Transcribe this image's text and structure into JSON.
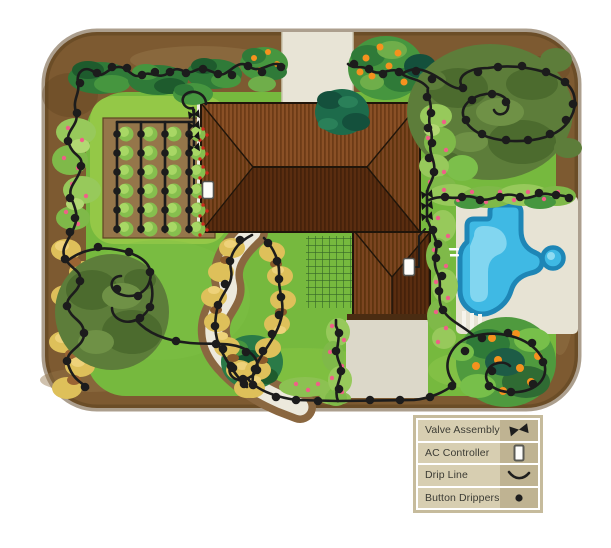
{
  "legend": {
    "items": [
      {
        "label": "Valve Assembly",
        "symbol": "valve-assembly-icon"
      },
      {
        "label": "AC Controller",
        "symbol": "ac-controller-icon"
      },
      {
        "label": "Drip Line",
        "symbol": "drip-line-icon"
      },
      {
        "label": "Button Drippers",
        "symbol": "button-dripper-icon"
      }
    ]
  },
  "colors": {
    "background": "#ffffff",
    "soil": "#7d5a31",
    "soil_dark": "#5e421f",
    "lawn": "#76b93e",
    "lawn_light": "#94c847",
    "hardscape": "#e8e4d6",
    "patio": "#dcd8c9",
    "roof_light": "#8a5026",
    "roof_dark": "#5a2d10",
    "pool_water": "#3fb9e4",
    "pool_border": "#1e86b6",
    "pool_highlight": "#8edbf2",
    "foliage_dark": "#2f7a38",
    "foliage_olive": "#5d7d3a",
    "foliage_light": "#97c95b",
    "shrub_gold": "#dec05a",
    "flower_pink": "#ef6088",
    "fruit_orange": "#f5921e",
    "drip_line": "#1c1c1c",
    "plant_green": "#86bf4e",
    "tomato_red": "#cc2b1e",
    "legend_frame": "#c6bb9c",
    "legend_label_bg": "#d7ceb1",
    "legend_symbol_bg": "#bfb392",
    "legend_text": "#3b3b34"
  },
  "plan": {
    "valve_assemblies": [
      [
        194,
        115
      ],
      [
        194,
        126
      ],
      [
        194,
        137
      ],
      [
        194,
        148
      ],
      [
        427,
        195
      ],
      [
        427,
        206
      ],
      [
        427,
        217
      ]
    ],
    "ac_controllers": [
      [
        208,
        190
      ],
      [
        409,
        267
      ]
    ],
    "vegetable_garden": {
      "columns": [
        117,
        141,
        165,
        189
      ],
      "rows": [
        134,
        153,
        172,
        191,
        210,
        229
      ],
      "tomato_column_index": 3
    },
    "drippers": [
      [
        281,
        67
      ],
      [
        262,
        72
      ],
      [
        248,
        66
      ],
      [
        232,
        75
      ],
      [
        218,
        74
      ],
      [
        203,
        69
      ],
      [
        186,
        73
      ],
      [
        170,
        72
      ],
      [
        155,
        72
      ],
      [
        142,
        75
      ],
      [
        127,
        68
      ],
      [
        112,
        67
      ],
      [
        97,
        73
      ],
      [
        80,
        83
      ],
      [
        77,
        113
      ],
      [
        68,
        141
      ],
      [
        81,
        166
      ],
      [
        70,
        198
      ],
      [
        75,
        218
      ],
      [
        70,
        232
      ],
      [
        65,
        259
      ],
      [
        80,
        281
      ],
      [
        67,
        306
      ],
      [
        84,
        333
      ],
      [
        67,
        361
      ],
      [
        85,
        387
      ],
      [
        98,
        247
      ],
      [
        129,
        252
      ],
      [
        150,
        272
      ],
      [
        138,
        296
      ],
      [
        117,
        289
      ],
      [
        150,
        307
      ],
      [
        140,
        318
      ],
      [
        176,
        341
      ],
      [
        216,
        344
      ],
      [
        246,
        352
      ],
      [
        257,
        370
      ],
      [
        243,
        379
      ],
      [
        231,
        366
      ],
      [
        276,
        397
      ],
      [
        296,
        400
      ],
      [
        318,
        401
      ],
      [
        339,
        389
      ],
      [
        341,
        371
      ],
      [
        336,
        351
      ],
      [
        339,
        333
      ],
      [
        370,
        400
      ],
      [
        400,
        400
      ],
      [
        430,
        397
      ],
      [
        452,
        386
      ],
      [
        465,
        351
      ],
      [
        482,
        338
      ],
      [
        508,
        333
      ],
      [
        532,
        343
      ],
      [
        543,
        362
      ],
      [
        533,
        384
      ],
      [
        511,
        392
      ],
      [
        489,
        386
      ],
      [
        492,
        371
      ],
      [
        443,
        310
      ],
      [
        439,
        291
      ],
      [
        442,
        276
      ],
      [
        436,
        258
      ],
      [
        438,
        244
      ],
      [
        433,
        230
      ],
      [
        434,
        172
      ],
      [
        429,
        158
      ],
      [
        432,
        143
      ],
      [
        428,
        128
      ],
      [
        431,
        113
      ],
      [
        427,
        97
      ],
      [
        399,
        72
      ],
      [
        383,
        74
      ],
      [
        369,
        69
      ],
      [
        354,
        64
      ],
      [
        416,
        71
      ],
      [
        432,
        79
      ],
      [
        463,
        88
      ],
      [
        478,
        72
      ],
      [
        498,
        67
      ],
      [
        522,
        66
      ],
      [
        546,
        72
      ],
      [
        565,
        82
      ],
      [
        573,
        104
      ],
      [
        566,
        120
      ],
      [
        550,
        134
      ],
      [
        528,
        140
      ],
      [
        506,
        140
      ],
      [
        482,
        134
      ],
      [
        466,
        120
      ],
      [
        472,
        100
      ],
      [
        492,
        94
      ],
      [
        506,
        102
      ],
      [
        445,
        197
      ],
      [
        462,
        197
      ],
      [
        480,
        200
      ],
      [
        500,
        197
      ],
      [
        520,
        197
      ],
      [
        539,
        193
      ],
      [
        556,
        195
      ],
      [
        569,
        198
      ],
      [
        240,
        240
      ],
      [
        230,
        261
      ],
      [
        225,
        284
      ],
      [
        218,
        305
      ],
      [
        215,
        326
      ],
      [
        223,
        349
      ],
      [
        233,
        368
      ],
      [
        244,
        384
      ],
      [
        268,
        243
      ],
      [
        277,
        261
      ],
      [
        279,
        279
      ],
      [
        281,
        297
      ],
      [
        279,
        315
      ],
      [
        272,
        334
      ],
      [
        263,
        351
      ],
      [
        255,
        369
      ],
      [
        253,
        385
      ]
    ]
  }
}
